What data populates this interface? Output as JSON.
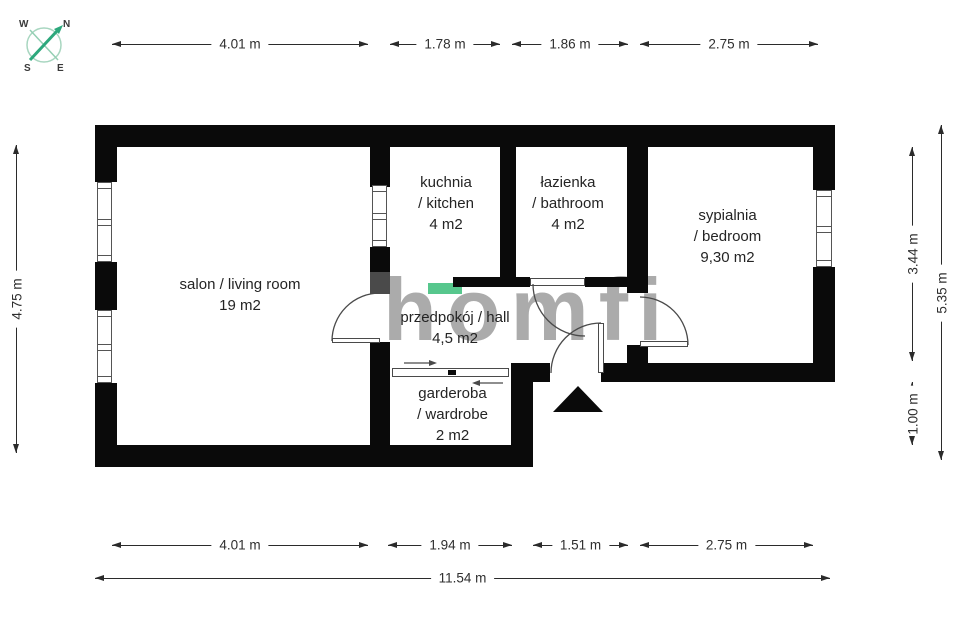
{
  "brand": {
    "text": "homfi"
  },
  "compass": {
    "w": "W",
    "n": "N",
    "s": "S",
    "e": "E"
  },
  "colors": {
    "wall": "#0a0a0a",
    "accent_green": "#57c78d",
    "compass_green": "#2ca87c",
    "watermark_gray": "#a3a3a3"
  },
  "rooms": [
    {
      "id": "salon",
      "lines": [
        "salon / living room",
        "19 m2"
      ]
    },
    {
      "id": "kitchen",
      "lines": [
        "kuchnia",
        "/ kitchen",
        "4 m2"
      ]
    },
    {
      "id": "bathroom",
      "lines": [
        "łazienka",
        "/ bathroom",
        "4 m2"
      ]
    },
    {
      "id": "bedroom",
      "lines": [
        "sypialnia",
        "/ bedroom",
        "9,30 m2"
      ]
    },
    {
      "id": "hall",
      "lines": [
        "przedpokój / hall",
        "4,5 m2"
      ]
    },
    {
      "id": "wardrobe",
      "lines": [
        "garderoba",
        "/ wardrobe",
        "2 m2"
      ]
    }
  ],
  "dimensions": {
    "top": [
      "4.01 m",
      "1.78 m",
      "1.86 m",
      "2.75 m"
    ],
    "bottom": [
      "4.01 m",
      "1.94 m",
      "1.51 m",
      "2.75 m"
    ],
    "left": [
      "4.75 m"
    ],
    "right": [
      "3.44 m",
      "5.35 m",
      "1.00 m"
    ],
    "total": "11.54 m"
  }
}
